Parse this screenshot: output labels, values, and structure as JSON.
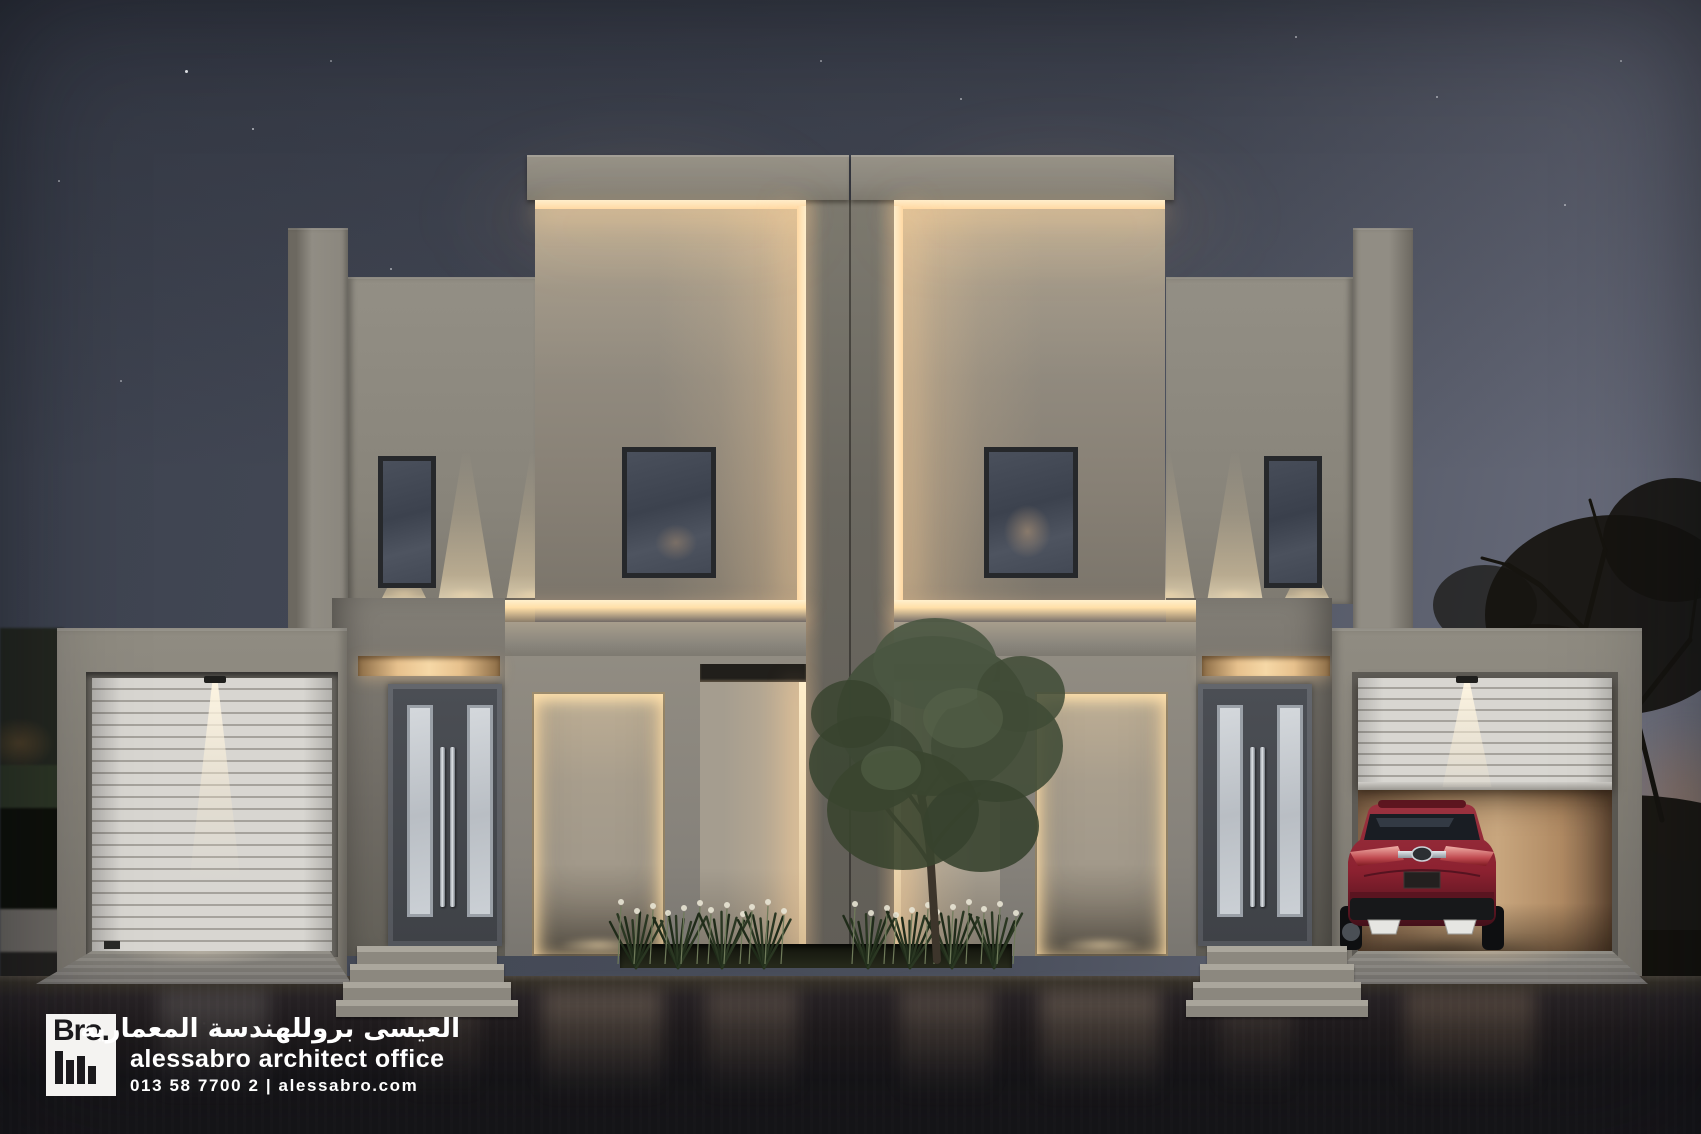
{
  "palette": {
    "sky-top": "#3d424f",
    "sky-mid": "#4b505d",
    "sky-horizon": "#717484",
    "dusk-glow": "#b07a4e",
    "facade": "#8f8b81",
    "facade-light": "#a49c8d",
    "facade-dark": "#6e6a62",
    "led-core": "#ffeecb",
    "led-glow": "#e9bf8a",
    "notch-dark": "#211f1b",
    "pier": "#716e66",
    "door-grey": "#45484e",
    "door-frame": "#5e6167",
    "glass-frost": "#c6cbd0",
    "handle-steel": "#c3c8cd",
    "window-glass": "#454b57",
    "shutter-white": "#d8d6d1",
    "shutter-gap": "#a5a29c",
    "garage-face": "#87837a",
    "garage-interior": "#bb9a76",
    "car-red": "#8c2130",
    "car-red-dark": "#55101b",
    "street": "#1e1b1d",
    "plinth": "#8e8a81",
    "step-tread": "#a6a299",
    "planter-green": "#2c381f",
    "trunk-brown": "#3d352b",
    "flower-white": "#e8e4d4",
    "park-dark": "#1d2018",
    "tree-silhouette": "#16140f",
    "star-white": "#f2f4f8",
    "text-white": "#ffffff",
    "logo-bg": "#f4f3f1",
    "logo-black": "#1a191c"
  },
  "icons": {
    "logo_mark": "bro-bars-icon",
    "car_badge": "lexus-badge-icon"
  },
  "branding": {
    "logo_text": "Bro.",
    "title_ar": "العيسى بروللهندسة المعمارية",
    "title_en": "alessabro architect office",
    "contact": "013 58 7700 2 | alessabro.com"
  }
}
